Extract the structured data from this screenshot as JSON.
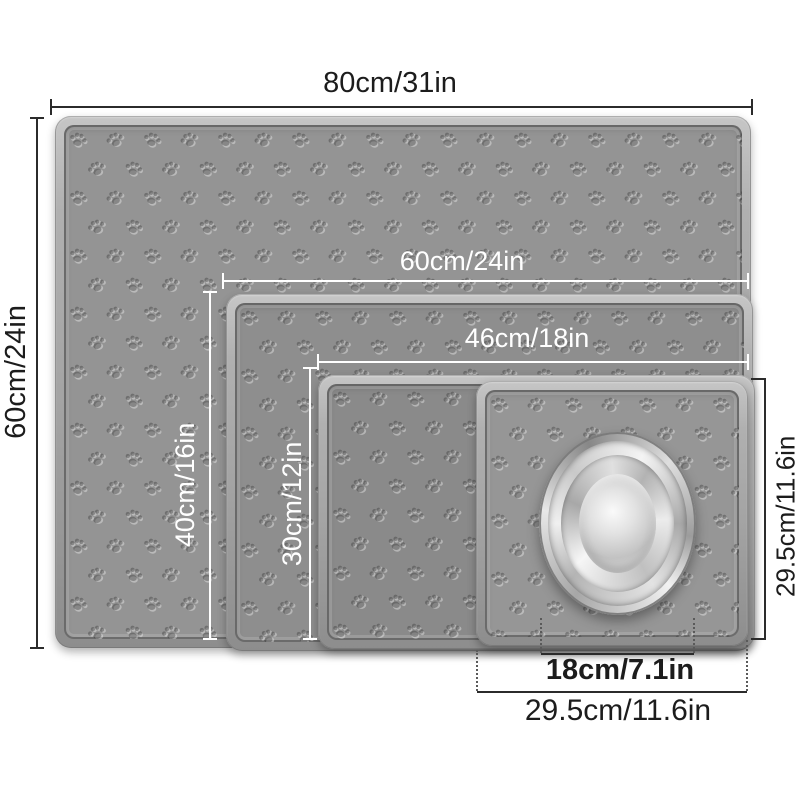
{
  "labels": {
    "mat_80x60": {
      "width": "80cm/31in",
      "height": "60cm/24in"
    },
    "mat_60x40": {
      "width": "60cm/24in",
      "height": "40cm/16in"
    },
    "mat_46x30": {
      "width": "46cm/18in",
      "height": "30cm/12in"
    },
    "mat_square": {
      "bottom_width": "29.5cm/11.6in",
      "right_height": "29.5cm/11.6in"
    },
    "bowl": {
      "diameter": "18cm/7.1in"
    }
  },
  "icons": {
    "mat_texture": "paw-print-pattern"
  },
  "colors": {
    "background": "#ffffff",
    "mat_surface": "#909090",
    "mat_rim": "#b5b5b5",
    "dimension_black": "#2b2b2b",
    "dimension_white": "#ffffff"
  }
}
